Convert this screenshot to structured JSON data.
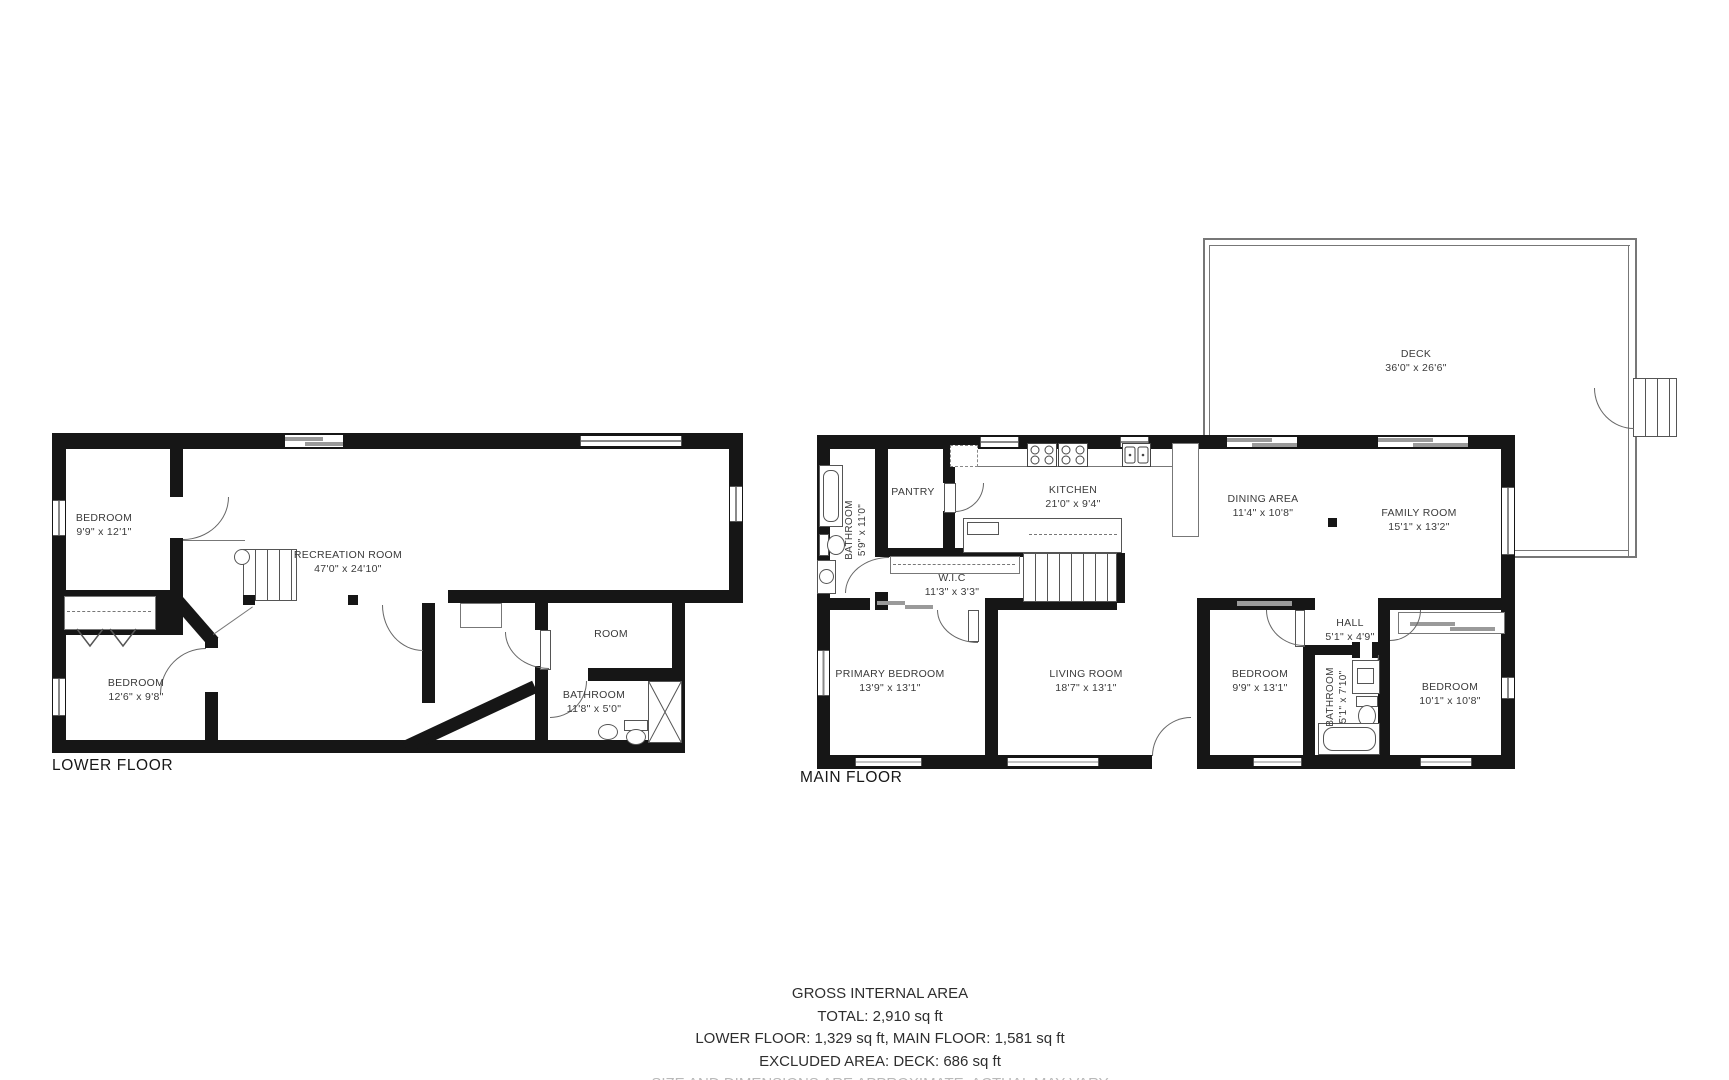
{
  "lower_floor": {
    "title": "LOWER FLOOR",
    "rooms": {
      "bedroom_top": {
        "name": "BEDROOM",
        "dims": "9'9\" x 12'1\""
      },
      "recreation": {
        "name": "RECREATION ROOM",
        "dims": "47'0\" x 24'10\""
      },
      "bedroom_bottom": {
        "name": "BEDROOM",
        "dims": "12'6\" x 9'8\""
      },
      "room": {
        "name": "ROOM"
      },
      "bathroom": {
        "name": "BATHROOM",
        "dims": "11'8\" x 5'0\""
      }
    }
  },
  "main_floor": {
    "title": "MAIN FLOOR",
    "rooms": {
      "bathroom_upper": {
        "name": "BATHROOM",
        "dims": "5'9\" x 11'0\""
      },
      "pantry": {
        "name": "PANTRY"
      },
      "kitchen": {
        "name": "KITCHEN",
        "dims": "21'0\" x 9'4\""
      },
      "dining": {
        "name": "DINING AREA",
        "dims": "11'4\" x 10'8\""
      },
      "family": {
        "name": "FAMILY ROOM",
        "dims": "15'1\" x 13'2\""
      },
      "wic": {
        "name": "W.I.C",
        "dims": "11'3\" x 3'3\""
      },
      "primary": {
        "name": "PRIMARY BEDROOM",
        "dims": "13'9\" x 13'1\""
      },
      "living": {
        "name": "LIVING ROOM",
        "dims": "18'7\" x 13'1\""
      },
      "bedroom_mid": {
        "name": "BEDROOM",
        "dims": "9'9\" x 13'1\""
      },
      "hall": {
        "name": "HALL",
        "dims": "5'1\" x 4'9\""
      },
      "bathroom_lower": {
        "name": "BATHROOM",
        "dims": "5'1\" x 7'10\""
      },
      "bedroom_right": {
        "name": "BEDROOM",
        "dims": "10'1\" x 10'8\""
      }
    }
  },
  "deck": {
    "name": "DECK",
    "dims": "36'0\" x 26'6\""
  },
  "summary": {
    "heading": "GROSS INTERNAL AREA",
    "total": "TOTAL: 2,910 sq ft",
    "floors": "LOWER FLOOR: 1,329 sq ft, MAIN FLOOR: 1,581 sq ft",
    "excluded": "EXCLUDED AREA: DECK: 686 sq ft",
    "disclaimer": "SIZE AND DIMENSIONS ARE APPROXIMATE, ACTUAL MAY VARY"
  }
}
